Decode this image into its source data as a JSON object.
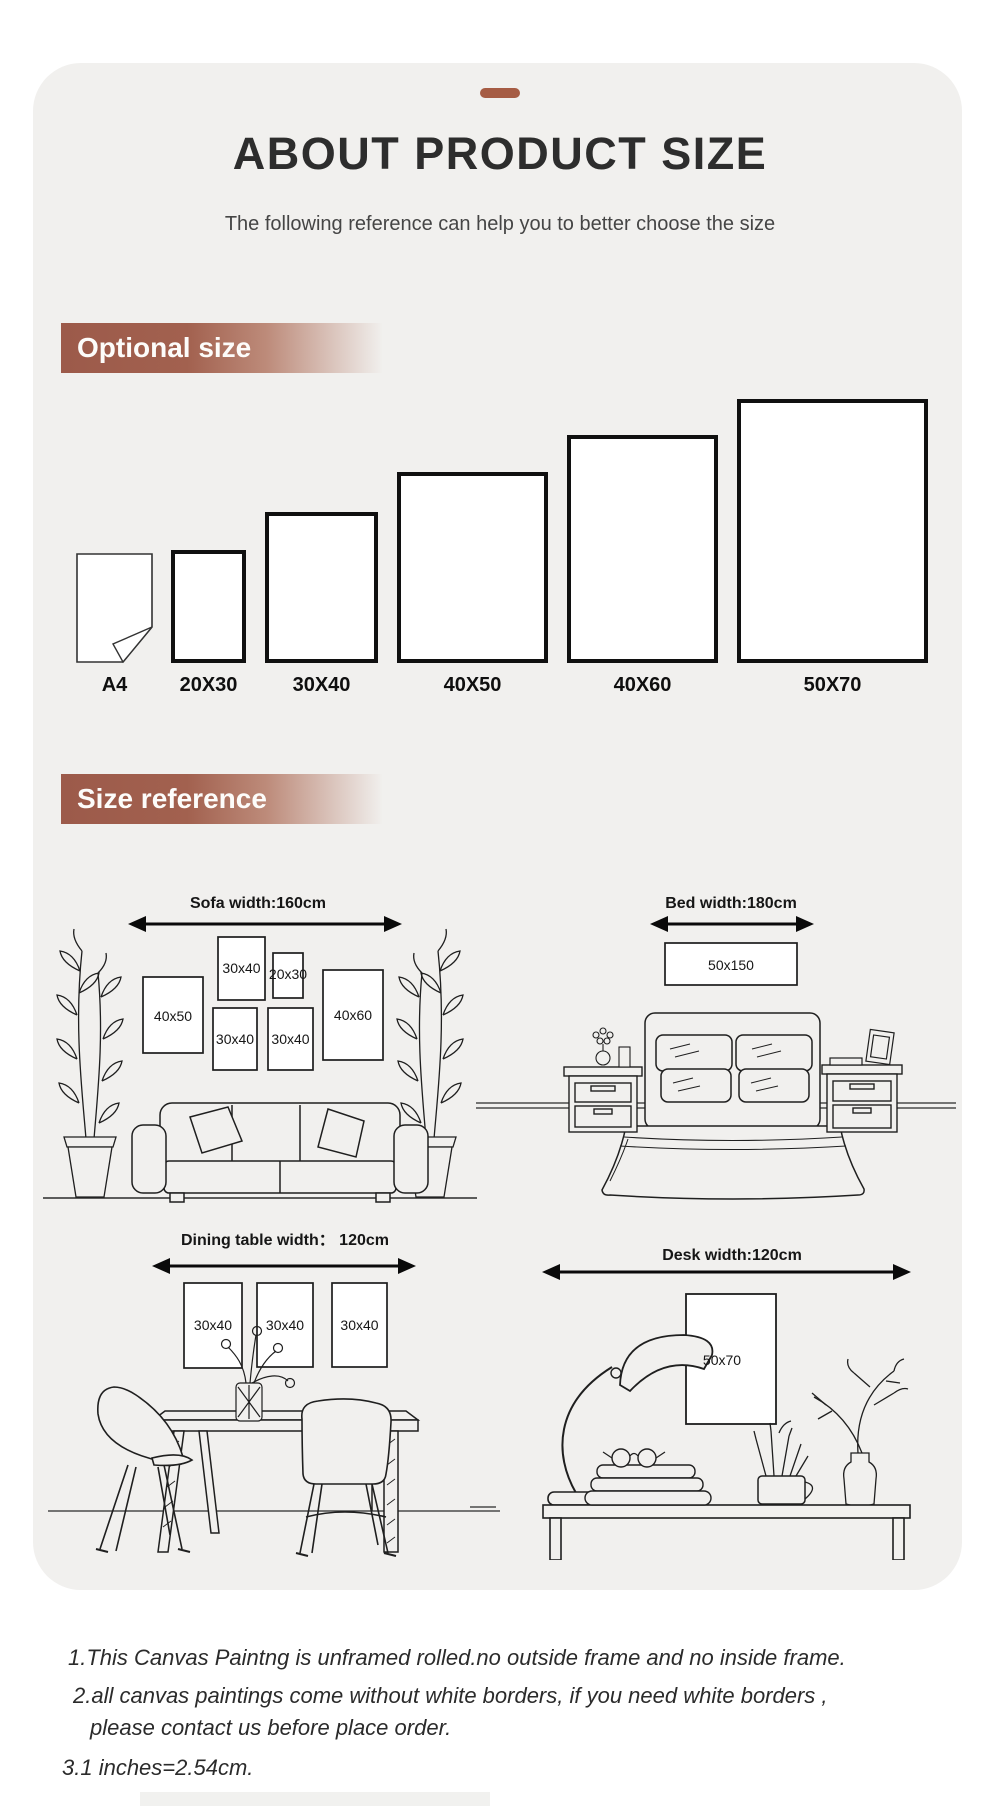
{
  "header": {
    "title": "ABOUT PRODUCT SIZE",
    "subtitle": "The following reference can help you to better choose the size"
  },
  "sections": {
    "optional": "Optional size",
    "reference": "Size reference"
  },
  "optional_sizes": [
    "A4",
    "20X30",
    "30X40",
    "40X50",
    "40X60",
    "50X70"
  ],
  "scenes": {
    "sofa": {
      "title": "Sofa width:160cm",
      "frames": [
        "40x50",
        "30x40",
        "20x30",
        "30x40",
        "30x40",
        "40x60"
      ]
    },
    "bed": {
      "title": "Bed width:180cm",
      "frames": [
        "50x150"
      ]
    },
    "dining": {
      "title": "Dining table width： 120cm",
      "frames": [
        "30x40",
        "30x40",
        "30x40"
      ]
    },
    "desk": {
      "title": "Desk width:120cm",
      "frames": [
        "50x70"
      ]
    }
  },
  "notes": {
    "n1": "1.This Canvas Paintng is unframed rolled.no outside frame and no inside frame.",
    "n2a": "2.all canvas paintings come without white borders, if you need white borders ,",
    "n2b": "please contact us before place order.",
    "n3": "3.1 inches=2.54cm."
  },
  "colors": {
    "accent": "#a65c44",
    "banner": "#9c5a4a",
    "card_bg": "#f1f0ee"
  }
}
